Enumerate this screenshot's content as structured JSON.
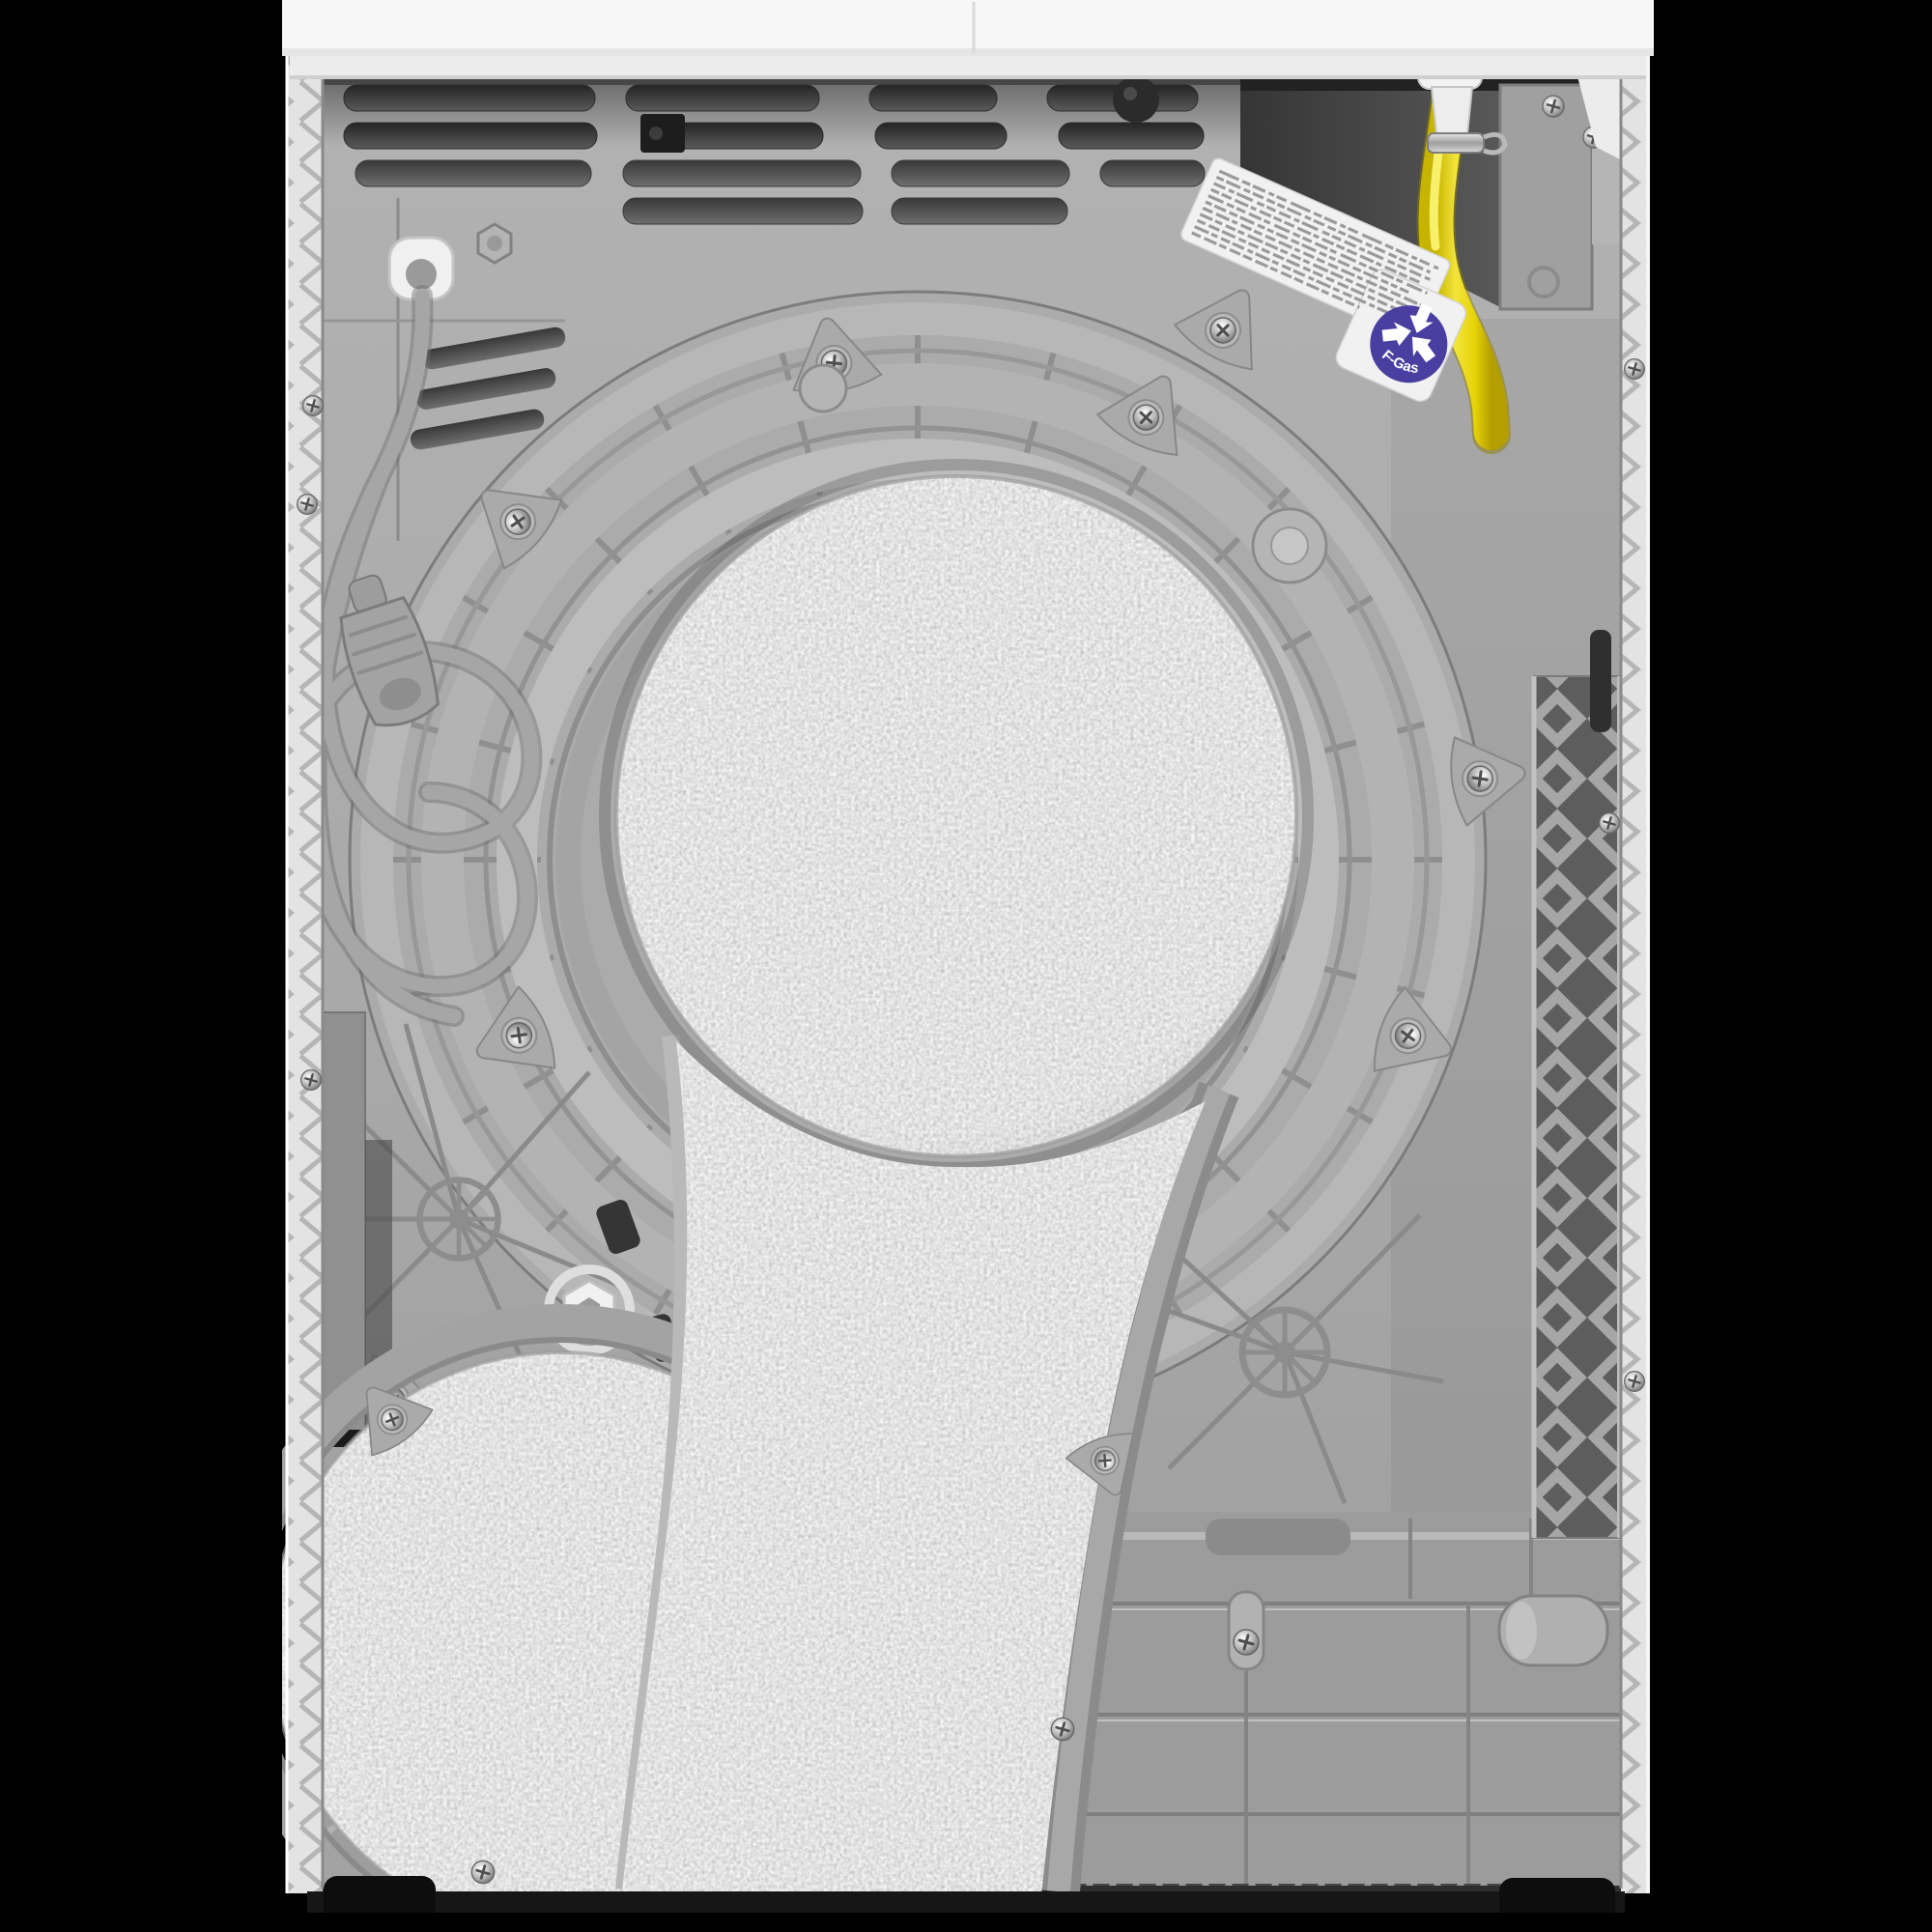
{
  "scene": {
    "description": "Rear view photograph of a white heat-pump tumble dryer with grey plastic back panel, coiled power cord, yellow condensate drain hose and felt-covered air duct pads",
    "background_color": "#000000"
  },
  "machine": {
    "top_panel_color": "#f7f7f7",
    "back_panel_color": "#a8a8a8",
    "vent_slot_color": "#3c3c3c",
    "felt_pad_color": "#cfcfcf",
    "drain_hose_color": "#e6d307",
    "power_cord_color": "#a6a6a6",
    "side_trim_color": "#e3e3e3"
  },
  "fgas_badge": {
    "text": "F-Gas",
    "bg_color": "#493fa1",
    "fg_color": "#ffffff"
  },
  "info_label": {
    "legible": false,
    "line_count": 11,
    "paper_color": "#f1f1f1"
  }
}
